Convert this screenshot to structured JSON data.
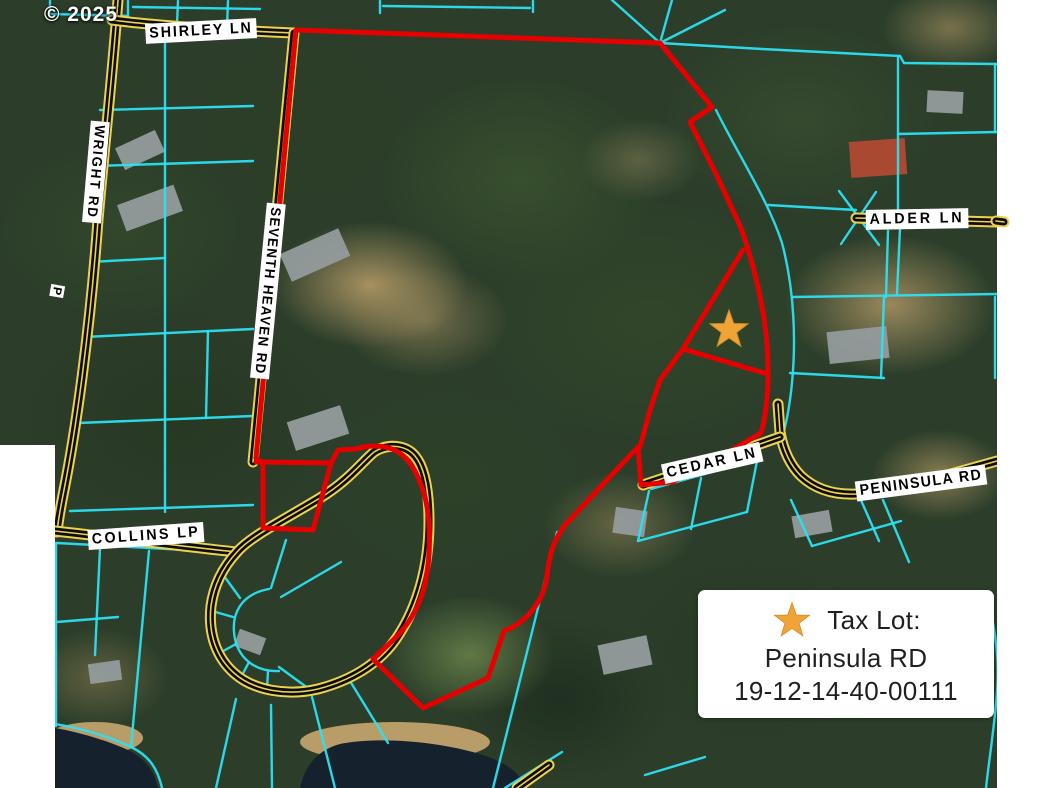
{
  "copyright": "© 2025",
  "road_labels": {
    "shirley": "SHIRLEY LN",
    "wright": "WRIGHT RD",
    "seventh_heaven": "SEVENTH HEAVEN RD",
    "alder": "ALDER LN",
    "cedar": "CEDAR LN",
    "peninsula": "PENINSULA RD",
    "collins": "COLLINS LP",
    "partial": "P"
  },
  "legend": {
    "line1": "Tax Lot:",
    "line2": "Peninsula RD",
    "line3": "19-12-14-40-00111"
  },
  "marker": {
    "shape": "star",
    "x": 729,
    "y": 330
  },
  "colors": {
    "parcel-line": "#2ce0f2",
    "boundary": "#e60000",
    "road-edge": "#ecd24f",
    "road-core": "#0d0d0d",
    "star": "#f0a437",
    "label-bg": "#ffffff",
    "label-text": "#000000",
    "water": "#15222e",
    "legend-text": "#1f1f1f"
  }
}
